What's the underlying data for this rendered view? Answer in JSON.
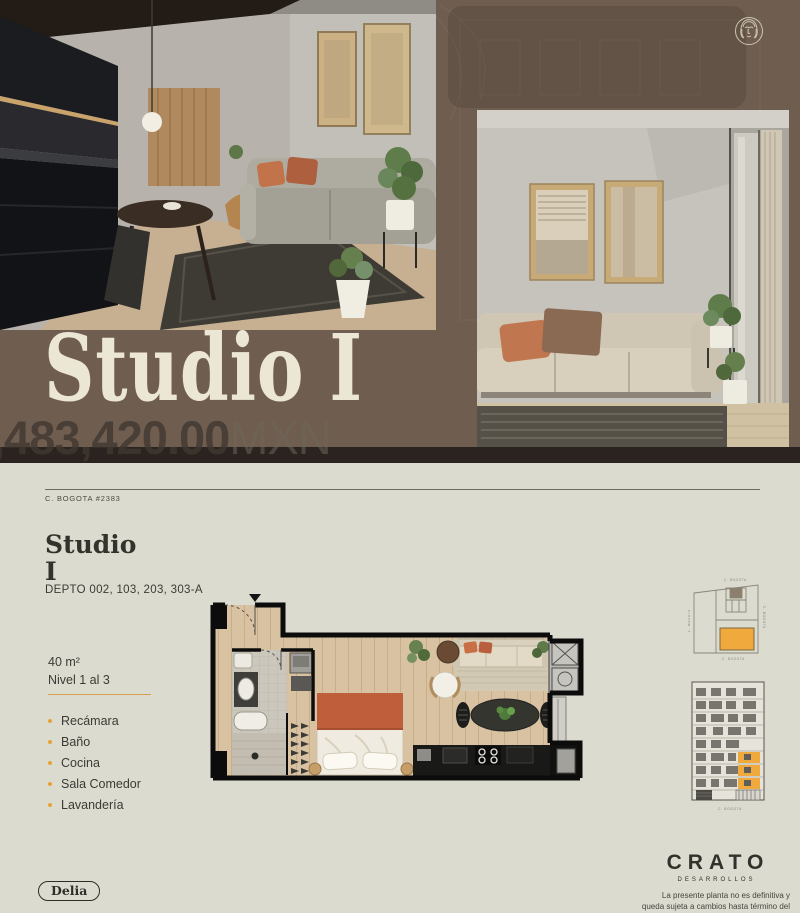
{
  "hero": {
    "title": "Studio I",
    "price_amount": ",483,420.00",
    "price_currency": "MXN"
  },
  "doc": {
    "address": "C. BOGOTA #2383",
    "unit_name_line1": "Studio",
    "unit_name_line2": "I",
    "depto": "DEPTO 002, 103, 203, 303-A",
    "area": "40 m²",
    "level": "Nivel 1 al 3",
    "features": [
      "Recámara",
      "Baño",
      "Cocina",
      "Sala Comedor",
      "Lavandería"
    ],
    "siteplan_labels": {
      "top": "C. BOGOTA",
      "bottom": "C. BOGOTA",
      "left": "C. BOGOTA",
      "right": "C. BOGOTA"
    },
    "elevation_street": "C. BOGOTA",
    "badge": "Delia",
    "brand": {
      "name": "CRATO",
      "subtitle": "DESARROLLOS",
      "disclaimer": "La presente planta no es definitiva y queda sujeta a cambios hasta término del proyecto."
    }
  },
  "colors": {
    "hero_brown": "#6F5D50",
    "divider_band": "#2A2320",
    "paper": "#DCDBD0",
    "accent_orange": "#E9A43C",
    "terracotta": "#BF5E3A",
    "ink": "#33332D"
  }
}
